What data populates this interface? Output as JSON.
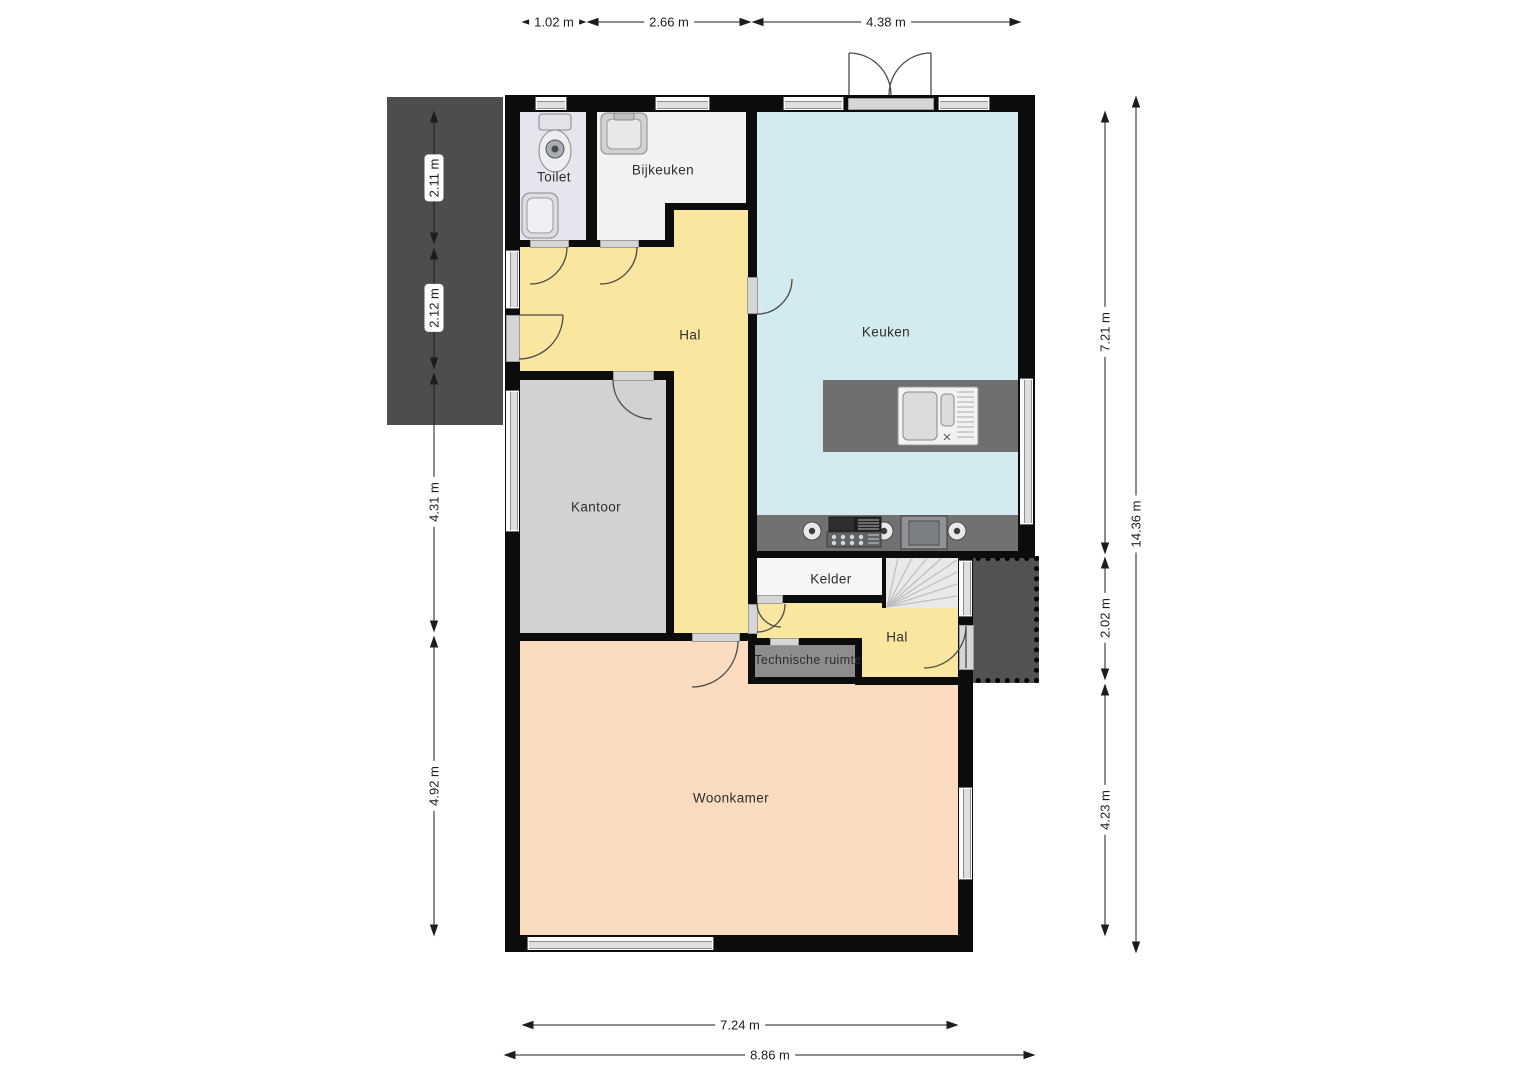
{
  "plan": {
    "rooms": {
      "toilet": {
        "label": "Toilet"
      },
      "bijkeuken": {
        "label": "Bijkeuken"
      },
      "keuken": {
        "label": "Keuken"
      },
      "hal": {
        "label": "Hal"
      },
      "kantoor": {
        "label": "Kantoor"
      },
      "kelder": {
        "label": "Kelder"
      },
      "technische_ruimte": {
        "label": "Technische ruimte"
      },
      "hal2": {
        "label": "Hal"
      },
      "woonkamer": {
        "label": "Woonkamer"
      }
    },
    "dimensions": {
      "top": [
        "1.02 m",
        "2.66 m",
        "4.38 m"
      ],
      "left": [
        "2.11 m",
        "2.12 m",
        "4.31 m",
        "4.92 m"
      ],
      "right_inner": [
        "7.21 m",
        "2.02 m",
        "4.23 m"
      ],
      "right_outer": "14.36 m",
      "bottom": [
        "7.24 m",
        "8.86 m"
      ]
    },
    "colors": {
      "hall_yellow": "#f9e7a0",
      "kitchen_blue": "#d3eaf0",
      "office_gray": "#d2d2d2",
      "living_peach": "#fbdcbe",
      "toilet_lilac": "#e4e5ed",
      "utility_white": "#f2f2f2",
      "basement_white": "#f6f6f6",
      "counter_gray": "#717171",
      "tech_gray": "#8d8d8d",
      "deck_dark": "#4d4d4e",
      "wall_black": "#0c0c0c"
    }
  }
}
